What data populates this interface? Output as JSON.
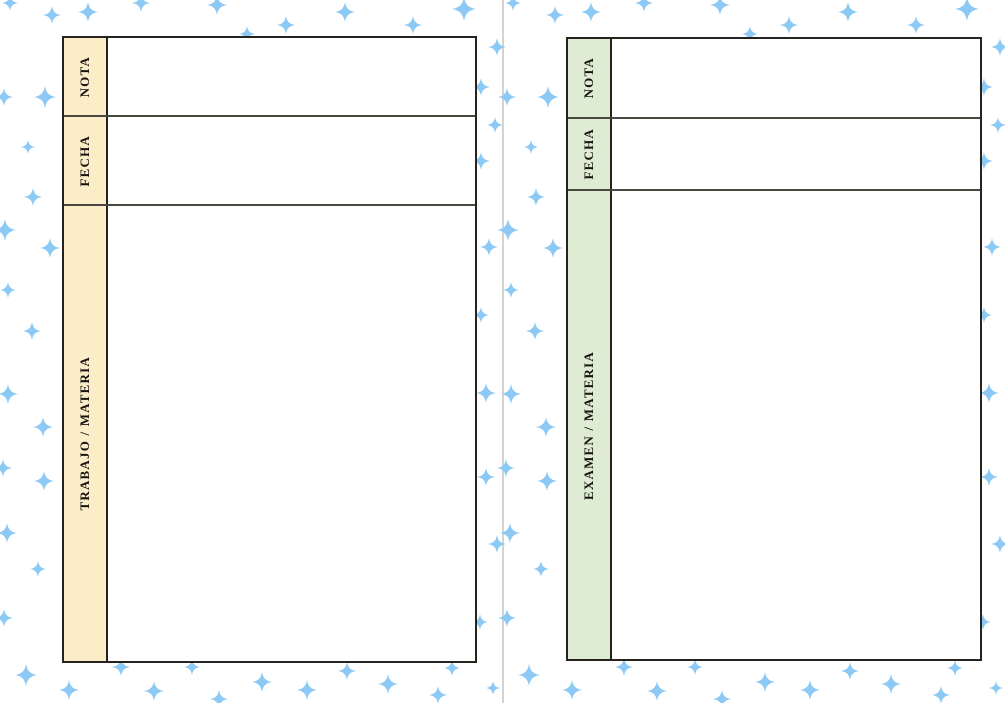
{
  "page": {
    "background": "#ffffff",
    "divider_color": "#d3d3d3"
  },
  "left_page": {
    "table": {
      "header_fill": "#fbedc8",
      "rows": [
        {
          "label": "NOTA"
        },
        {
          "label": "FECHA"
        },
        {
          "label": "TRABAJO / MATERIA"
        }
      ]
    }
  },
  "right_page": {
    "table": {
      "header_fill": "#dfecd4",
      "rows": [
        {
          "label": "NOTA"
        },
        {
          "label": "FECHA"
        },
        {
          "label": "EXAMEN / MATERIA"
        }
      ]
    }
  },
  "sparkles": {
    "color": "#8cc9f5",
    "half_offsets": [
      0,
      503
    ],
    "positions": [
      {
        "x": 10,
        "y": 3,
        "s": 16
      },
      {
        "x": 52,
        "y": 15,
        "s": 18
      },
      {
        "x": 88,
        "y": 12,
        "s": 20
      },
      {
        "x": 141,
        "y": 3,
        "s": 18
      },
      {
        "x": 217,
        "y": 5,
        "s": 20
      },
      {
        "x": 247,
        "y": 34,
        "s": 16
      },
      {
        "x": 286,
        "y": 25,
        "s": 18
      },
      {
        "x": 345,
        "y": 12,
        "s": 20
      },
      {
        "x": 413,
        "y": 25,
        "s": 18
      },
      {
        "x": 464,
        "y": 9,
        "s": 24
      },
      {
        "x": 497,
        "y": 47,
        "s": 18
      },
      {
        "x": 4,
        "y": 97,
        "s": 18
      },
      {
        "x": 45,
        "y": 97,
        "s": 22
      },
      {
        "x": 481,
        "y": 87,
        "s": 18
      },
      {
        "x": 28,
        "y": 147,
        "s": 14
      },
      {
        "x": 495,
        "y": 125,
        "s": 16
      },
      {
        "x": 481,
        "y": 161,
        "s": 18
      },
      {
        "x": 33,
        "y": 197,
        "s": 18
      },
      {
        "x": 5,
        "y": 230,
        "s": 22
      },
      {
        "x": 50,
        "y": 248,
        "s": 20
      },
      {
        "x": 489,
        "y": 247,
        "s": 18
      },
      {
        "x": 8,
        "y": 290,
        "s": 16
      },
      {
        "x": 32,
        "y": 331,
        "s": 18
      },
      {
        "x": 481,
        "y": 315,
        "s": 16
      },
      {
        "x": 8,
        "y": 394,
        "s": 20
      },
      {
        "x": 43,
        "y": 427,
        "s": 20
      },
      {
        "x": 3,
        "y": 468,
        "s": 18
      },
      {
        "x": 44,
        "y": 481,
        "s": 20
      },
      {
        "x": 7,
        "y": 533,
        "s": 20
      },
      {
        "x": 38,
        "y": 569,
        "s": 16
      },
      {
        "x": 486,
        "y": 393,
        "s": 20
      },
      {
        "x": 486,
        "y": 477,
        "s": 18
      },
      {
        "x": 497,
        "y": 544,
        "s": 18
      },
      {
        "x": 4,
        "y": 618,
        "s": 18
      },
      {
        "x": 480,
        "y": 622,
        "s": 16
      },
      {
        "x": 26,
        "y": 675,
        "s": 22
      },
      {
        "x": 69,
        "y": 690,
        "s": 20
      },
      {
        "x": 121,
        "y": 667,
        "s": 18
      },
      {
        "x": 154,
        "y": 691,
        "s": 20
      },
      {
        "x": 192,
        "y": 667,
        "s": 16
      },
      {
        "x": 219,
        "y": 699,
        "s": 18
      },
      {
        "x": 262,
        "y": 682,
        "s": 20
      },
      {
        "x": 307,
        "y": 690,
        "s": 20
      },
      {
        "x": 347,
        "y": 671,
        "s": 18
      },
      {
        "x": 388,
        "y": 684,
        "s": 20
      },
      {
        "x": 452,
        "y": 668,
        "s": 16
      },
      {
        "x": 438,
        "y": 695,
        "s": 18
      },
      {
        "x": 493,
        "y": 688,
        "s": 14
      }
    ]
  }
}
